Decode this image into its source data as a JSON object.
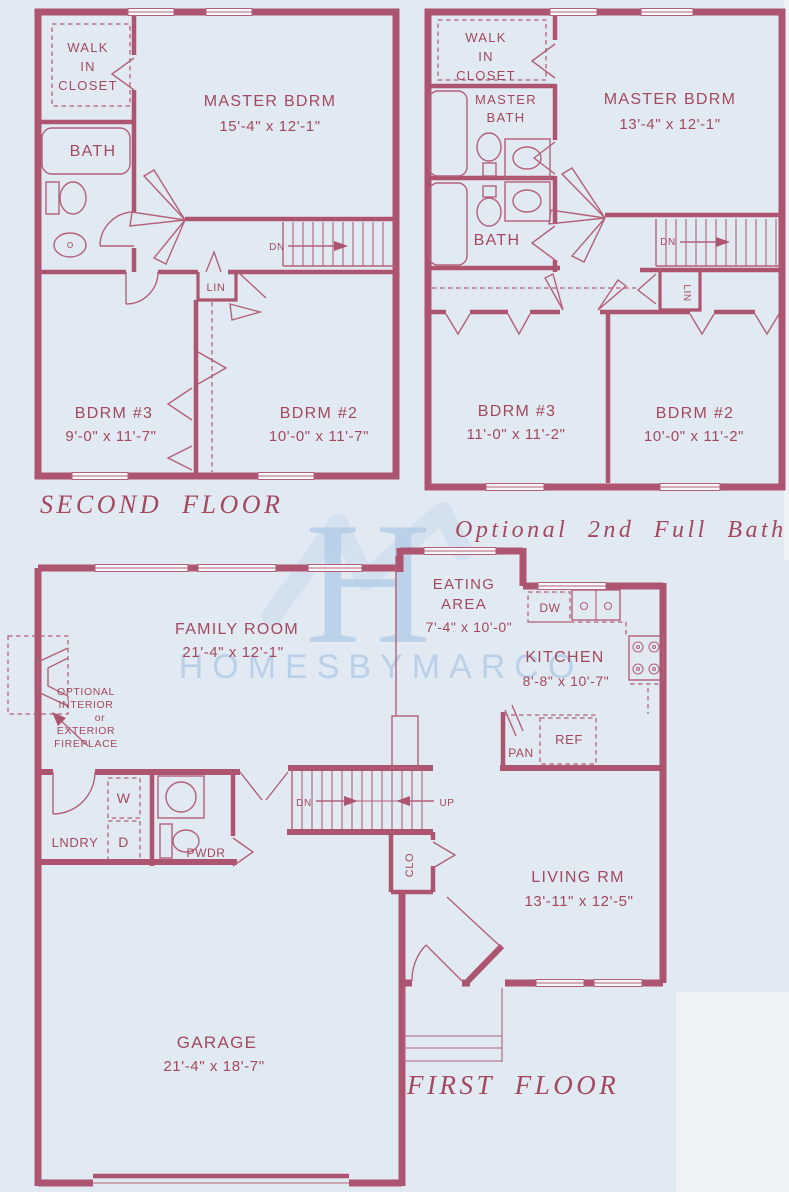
{
  "colors": {
    "wall": "#ad5470",
    "line": "#b4607a",
    "ink": "#a3485e",
    "bg": "#e1eaf2",
    "bgEdge": "#eef2f6",
    "watermark": "#b6cee8",
    "watermarkLight": "#cfdfee"
  },
  "watermark": {
    "mark": "H",
    "brand": "HOMESBYMARCO"
  },
  "second_floor": {
    "title": "SECOND FLOOR",
    "walk_in": {
      "l1": "WALK",
      "l2": "IN",
      "l3": "CLOSET"
    },
    "bath": "BATH",
    "master": {
      "name": "MASTER BDRM",
      "dims": "15'-4\" x 12'-1\""
    },
    "stairs": {
      "dn": "DN"
    },
    "linen": "LIN",
    "bdrm3": {
      "name": "BDRM #3",
      "dims": "9'-0\" x 11'-7\""
    },
    "bdrm2": {
      "name": "BDRM #2",
      "dims": "10'-0\" x 11'-7\""
    }
  },
  "optional_floor": {
    "title": "Optional 2nd Full Bath",
    "walk_in": {
      "l1": "WALK",
      "l2": "IN",
      "l3": "CLOSET"
    },
    "master_bath": {
      "l1": "MASTER",
      "l2": "BATH"
    },
    "master": {
      "name": "MASTER BDRM",
      "dims": "13'-4\" x 12'-1\""
    },
    "bath": "BATH",
    "stairs": {
      "dn": "DN"
    },
    "linen": "LIN",
    "bdrm3": {
      "name": "BDRM #3",
      "dims": "11'-0\" x 11'-2\""
    },
    "bdrm2": {
      "name": "BDRM #2",
      "dims": "10'-0\" x 11'-2\""
    }
  },
  "first_floor": {
    "title": "FIRST FLOOR",
    "family": {
      "name": "FAMILY ROOM",
      "dims": "21'-4\" x 12'-1\""
    },
    "fireplace_note": {
      "l1": "OPTIONAL",
      "l2": "INTERIOR",
      "l3": "or",
      "l4": "EXTERIOR",
      "l5": "FIREPLACE"
    },
    "eating": {
      "l1": "EATING",
      "l2": "AREA",
      "dims": "7'-4\" x 10'-0\""
    },
    "kitchen": {
      "name": "KITCHEN",
      "dims": "8'-8\" x 10'-7\""
    },
    "appliances": {
      "dw": "DW",
      "ref": "REF",
      "pan": "PAN",
      "washer": "W",
      "dryer": "D"
    },
    "laundry": "LNDRY",
    "powder": "PWDR",
    "stairs": {
      "dn": "DN",
      "up": "UP"
    },
    "closet": "CLO",
    "living": {
      "name": "LIVING RM",
      "dims": "13'-11\" x 12'-5\""
    },
    "garage": {
      "name": "GARAGE",
      "dims": "21'-4\" x 18'-7\""
    }
  }
}
